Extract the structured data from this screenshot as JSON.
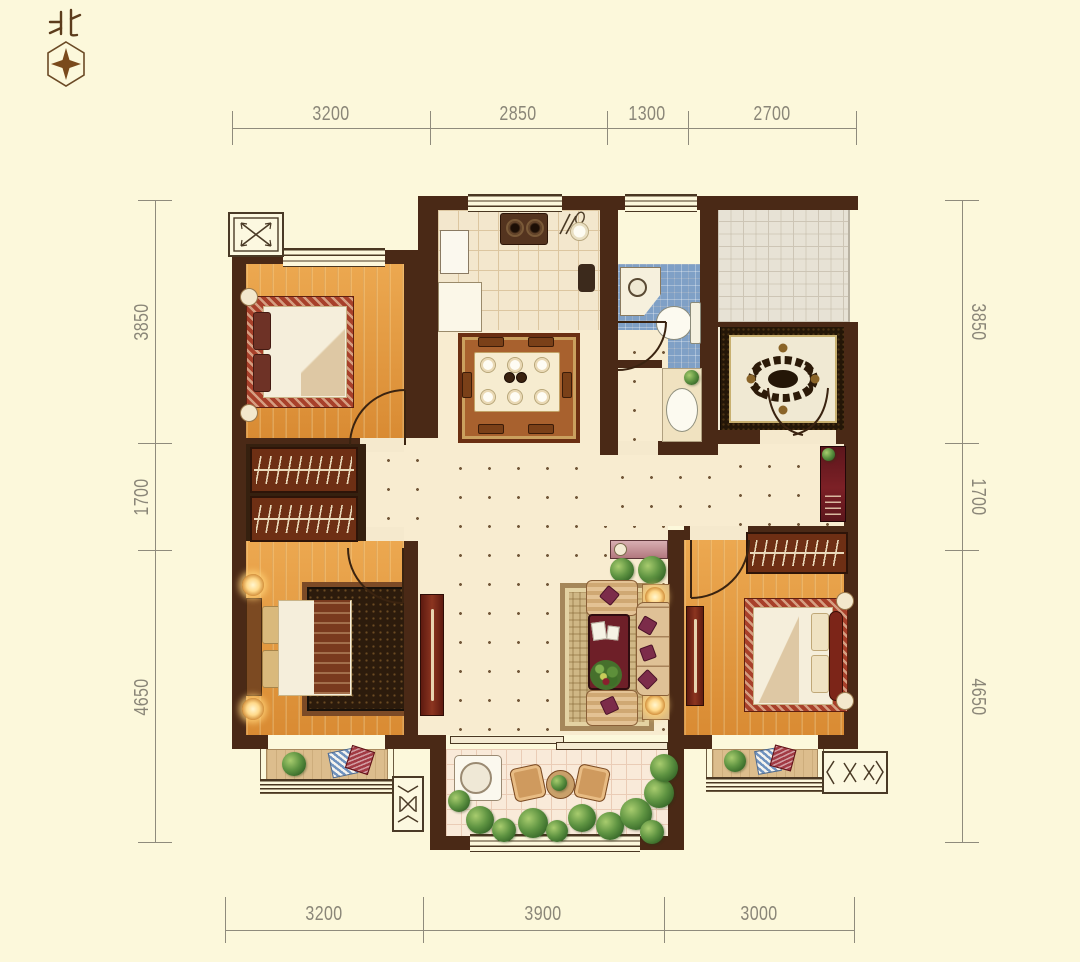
{
  "compass": {
    "label": "北"
  },
  "dimensions": {
    "top": [
      "3200",
      "2850",
      "1300",
      "2700"
    ],
    "bottom": [
      "3200",
      "3900",
      "3000"
    ],
    "left": [
      "3850",
      "1700",
      "4650"
    ],
    "right": [
      "3850",
      "1700",
      "4650"
    ]
  },
  "palette": {
    "background": "#fcf8db",
    "wall": "#4a2916",
    "wood_floor": "#e29a43",
    "hall_tile": "#f8ecd0",
    "bath_tile": "#7fa0c6",
    "public_tile": "#e7e2d5",
    "balcony_tile": "#f9ead9",
    "furniture_red": "#7c2418",
    "dimension_text": "#8a8678"
  },
  "icons": {
    "compass": "hexagon-with-four-point-star",
    "shaft": "box-with-x-cross-arrows",
    "ac_platform": "box-with-x-and-chevrons",
    "door": "quarter-circle-swing-arc",
    "window": "parallel-lines"
  }
}
